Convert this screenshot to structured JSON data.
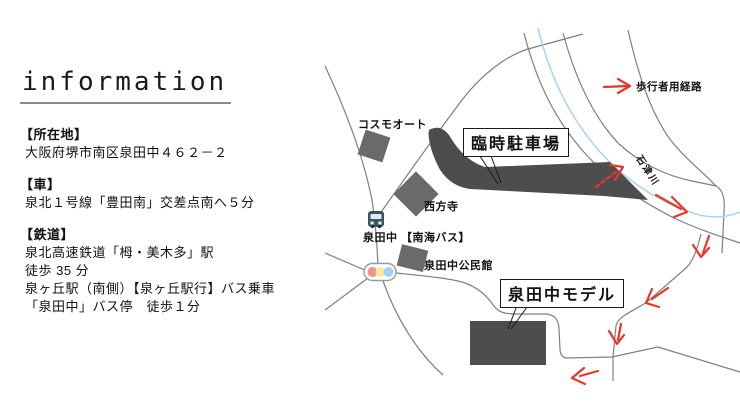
{
  "page": {
    "title": "information"
  },
  "info": {
    "sections": [
      {
        "heading": "【所在地】",
        "lines": [
          "大阪府堺市南区泉田中４６２－２"
        ]
      },
      {
        "heading": "【車】",
        "lines": [
          "泉北１号線「豊田南」交差点南へ５分"
        ]
      },
      {
        "heading": "【鉄道】",
        "lines": [
          "泉北高速鉄道「栂・美木多」駅",
          "徒歩 35 分",
          "泉ヶ丘駅（南側）【泉ヶ丘駅行】バス乗車",
          "「泉田中」バス停　徒歩１分"
        ]
      }
    ]
  },
  "map": {
    "labels": {
      "cosmo_auto": "コスモオート",
      "temple": "西方寺",
      "bus_stop": "泉田中 【南海バス】",
      "community_center": "泉田中公民館",
      "parking_box": "臨時駐車場",
      "model_box": "泉田中モデル",
      "river": "石津川",
      "pedestrian_route": "歩行者用経路"
    },
    "legend": {
      "traffic_light_colors": [
        "#f4938c",
        "#f5eb9a",
        "#9fd2f5"
      ]
    },
    "colors": {
      "building": "#6a6a6a",
      "dark_area": "#4d4d4d",
      "road": "#7f7f7f",
      "river": "#a9d7f2",
      "arrow": "#e8362a"
    }
  }
}
